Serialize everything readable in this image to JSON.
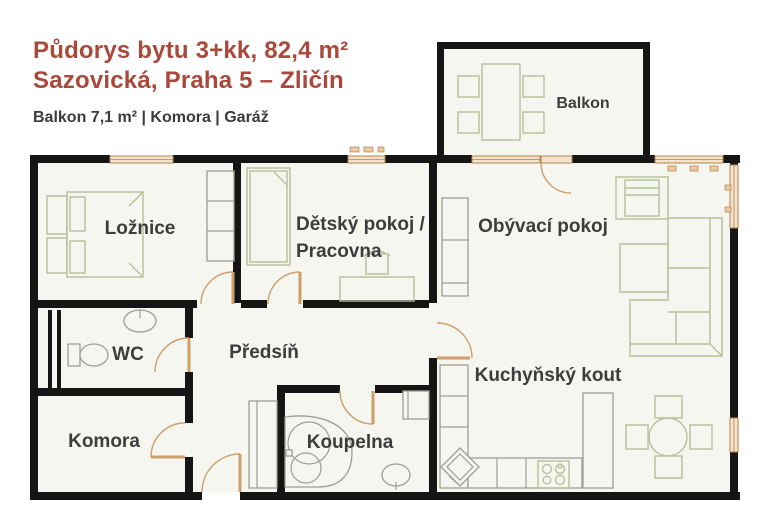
{
  "header": {
    "title_line1": "Půdorys bytu 3+kk, 82,4 m²",
    "title_line2": "Sazovická, Praha 5 – Zličín",
    "subtitle": "Balkon 7,1 m² | Komora | Garáž"
  },
  "plan": {
    "rooms": {
      "loznice": "Ložnice",
      "detsky_line1": "Dětský pokoj /",
      "detsky_line2": "Pracovna",
      "obyvaci": "Obývací pokoj",
      "kuchynsky": "Kuchyňský kout",
      "wc": "WC",
      "predsin": "Předsíň",
      "komora": "Komora",
      "koupelna": "Koupelna",
      "balkon": "Balkon"
    },
    "colors": {
      "title_red": "#a8493b",
      "label_gray": "#3d3d3d",
      "wall_black": "#151515",
      "floor": "#f4f6ef",
      "furniture_olive": "#b6c09c",
      "fixture_gray": "#9aa092",
      "window_tan": "#f3e3cb",
      "door_tan": "#cf9f6b"
    }
  }
}
